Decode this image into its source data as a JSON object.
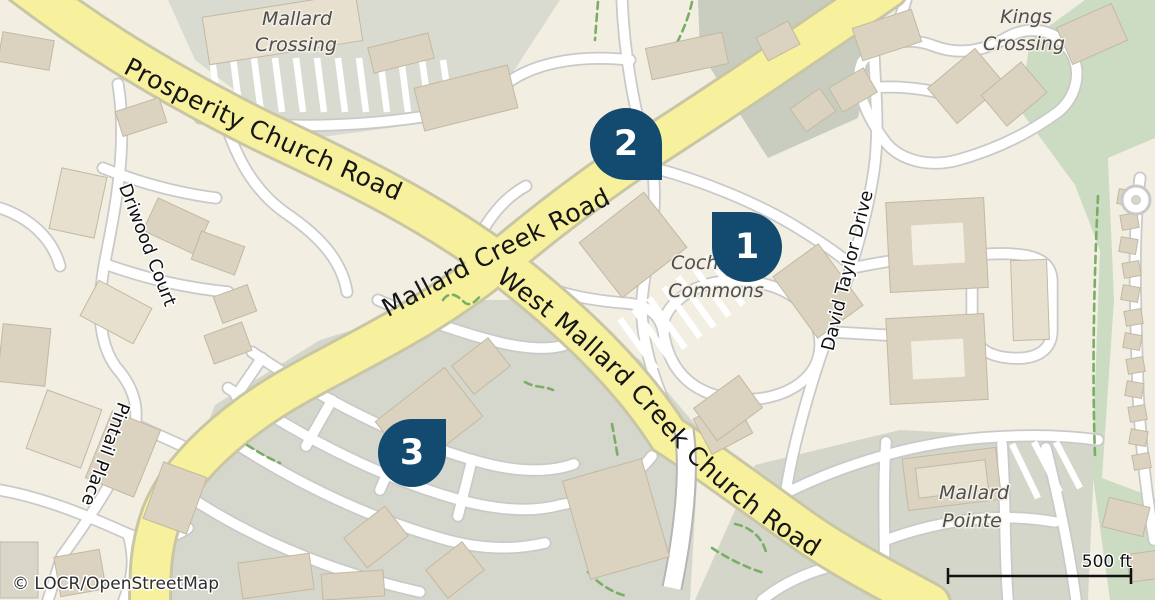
{
  "map": {
    "attribution": "© LOCR/OpenStreetMap",
    "scale_bar": {
      "label": "500 ft"
    },
    "markers": [
      {
        "number": "1"
      },
      {
        "number": "2"
      },
      {
        "number": "3"
      }
    ],
    "roads": {
      "prosperity": "Prosperity Church Road",
      "mallard_creek": "Mallard Creek Road",
      "west_mallard": "West Mallard Creek Church Road",
      "driwood": "Driwood Court",
      "pintail": "Pintail Place",
      "david_taylor": "David Taylor Drive"
    },
    "places": {
      "mallard_crossing_1": "Mallard",
      "mallard_crossing_2": "Crossing",
      "kings_crossing_1": "Kings",
      "kings_crossing_2": "Crossing",
      "cochran_commons_1": "Cochran",
      "cochran_commons_2": "Commons",
      "mallard_pointe_1": "Mallard",
      "mallard_pointe_2": "Pointe"
    },
    "colors": {
      "marker_fill": "#134a70",
      "marker_number": "#ffffff",
      "primary_road": "#f7f09c",
      "minor_road": "#ffffff",
      "woods_green": "#ccdcc2",
      "parking_gray": "#d9dbd0",
      "building_tan": "#dbd2bf",
      "place_label_gray": "#4e4e4e"
    }
  }
}
